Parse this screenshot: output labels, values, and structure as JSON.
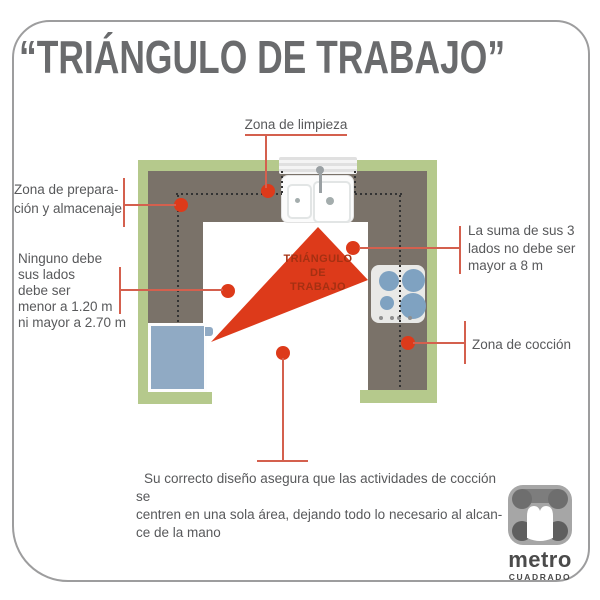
{
  "title": "“TRIÁNGULO DE TRABAJO”",
  "callouts": {
    "limpieza": "Zona de limpieza",
    "preparacion": "Zona de prepara-\nción y almacenaje",
    "lados": "Ninguno debe\nsus lados\ndebe ser\nmenor a 1.20 m\nni mayor a 2.70 m",
    "suma": "La suma de sus 3\nlados no debe ser\nmayor a 8 m",
    "coccion": "Zona de cocción"
  },
  "triangle_label": "TRIÁNGULO\nDE\nTRABAJO",
  "footer": "Su correcto diseño asegura que las actividades de cocción se\ncentren en una sola área, dejando todo lo necesario al alcan-\nce de la mano",
  "logo": {
    "name": "metro",
    "subname": "CUADRADO"
  },
  "icons": {
    "sink": "sink-icon",
    "window": "window-icon",
    "stove": "stove-icon",
    "fridge": "fridge-icon",
    "logo": "metro-cuadrado-logo-icon"
  },
  "colors": {
    "wall_green": "#b5c98c",
    "counter_gray": "#7a7269",
    "triangle_red": "#dd3a1a",
    "triangle_text_red": "#a53012",
    "callout_line_red": "#d4604e",
    "label_gray": "#58595b",
    "fridge_blue": "#90aac4",
    "burner_blue": "#7fa2c1"
  }
}
